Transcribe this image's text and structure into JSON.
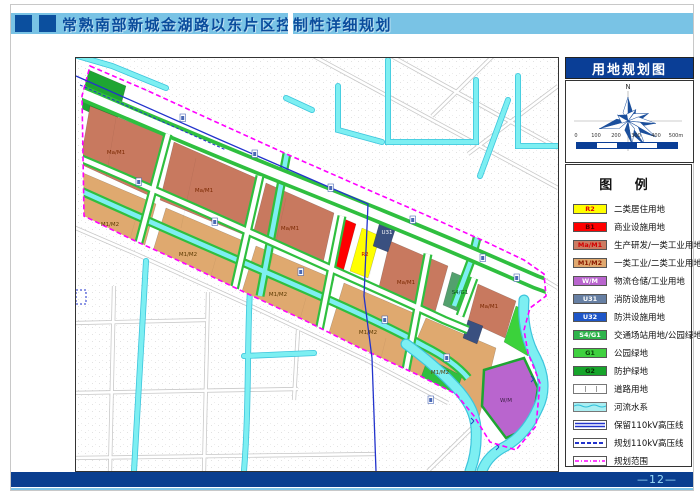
{
  "header": {
    "title": "常熟南部新城金湖路以东片区控制性详细规划"
  },
  "panel": {
    "map_title": "用地规划图",
    "compass_north": "N",
    "scale_labels": [
      "0",
      "100",
      "200",
      "300",
      "400",
      "500m"
    ],
    "legend_title": "图  例",
    "legend_items": [
      {
        "type": "code",
        "code": "R2",
        "bg": "#FFFF00",
        "fg": "#E60000",
        "label": "二类居住用地"
      },
      {
        "type": "code",
        "code": "B1",
        "bg": "#FF0000",
        "fg": "#4D0000",
        "label": "商业设施用地"
      },
      {
        "type": "code",
        "code": "Ma/M1",
        "bg": "#CC7B62",
        "fg": "#D40000",
        "label": "生产研发/一类工业用地"
      },
      {
        "type": "code",
        "code": "M1/M2",
        "bg": "#E0A96F",
        "fg": "#8B1A00",
        "label": "一类工业/二类工业用地"
      },
      {
        "type": "code",
        "code": "W/M",
        "bg": "#B965CE",
        "fg": "#FFFFFF",
        "label": "物流仓储/工业用地"
      },
      {
        "type": "code",
        "code": "U31",
        "bg": "#667FA3",
        "fg": "#FFFFFF",
        "label": "消防设施用地"
      },
      {
        "type": "code",
        "code": "U32",
        "bg": "#1E56C8",
        "fg": "#FFFFFF",
        "label": "防洪设施用地"
      },
      {
        "type": "code",
        "code": "S4/G1",
        "bg": "#2FB44B",
        "fg": "#FFFFFF",
        "label": "交通场站用地/公园绿地"
      },
      {
        "type": "code",
        "code": "G1",
        "bg": "#3FD13F",
        "fg": "#0A4A0A",
        "label": "公园绿地"
      },
      {
        "type": "code",
        "code": "G2",
        "bg": "#17A42B",
        "fg": "#063306",
        "label": "防护绿地"
      },
      {
        "type": "road",
        "label": "道路用地"
      },
      {
        "type": "water",
        "label": "河流水系"
      },
      {
        "type": "kv_keep",
        "label": "保留110kV高压线"
      },
      {
        "type": "kv_plan",
        "label": "规划110kV高压线"
      },
      {
        "type": "scope",
        "label": "规划范围"
      }
    ]
  },
  "map": {
    "labels": [
      {
        "t": "Ma/M1",
        "x": 40,
        "y": 96,
        "c": "#7A2800"
      },
      {
        "t": "Ma/M1",
        "x": 128,
        "y": 134,
        "c": "#7A2800"
      },
      {
        "t": "Ma/M1",
        "x": 214,
        "y": 172,
        "c": "#7A2800"
      },
      {
        "t": "Ma/M1",
        "x": 330,
        "y": 226,
        "c": "#7A2800"
      },
      {
        "t": "Ma/M1",
        "x": 413,
        "y": 250,
        "c": "#7A2800"
      },
      {
        "t": "M1/M2",
        "x": 34,
        "y": 168,
        "c": "#5C3A00"
      },
      {
        "t": "M1/M2",
        "x": 112,
        "y": 198,
        "c": "#5C3A00"
      },
      {
        "t": "M1/M2",
        "x": 202,
        "y": 238,
        "c": "#5C3A00"
      },
      {
        "t": "M1/M2",
        "x": 292,
        "y": 276,
        "c": "#5C3A00"
      },
      {
        "t": "M1/M2",
        "x": 364,
        "y": 316,
        "c": "#5C3A00"
      },
      {
        "t": "R2",
        "x": 289,
        "y": 198,
        "c": "#C00000"
      },
      {
        "t": "U31",
        "x": 311,
        "y": 176,
        "c": "#FFFFFF"
      },
      {
        "t": "S4/G1",
        "x": 384,
        "y": 236,
        "c": "#0B4A20"
      },
      {
        "t": "W/M",
        "x": 430,
        "y": 344,
        "c": "#3A1D42"
      }
    ]
  },
  "footer": {
    "page_label": "—12—"
  },
  "colors": {
    "header_band": "#79C3E5",
    "dark_blue": "#0B4F9E",
    "footer_bar": "#0A3E8F",
    "page_number_text": "#9ADCF8",
    "boundary_magenta": "#FF00FF",
    "water_cyan": "#7DEFF2",
    "green_park": "#3BD23B",
    "green_buffer": "#1EA532",
    "powerline_blue": "#2233CC"
  }
}
